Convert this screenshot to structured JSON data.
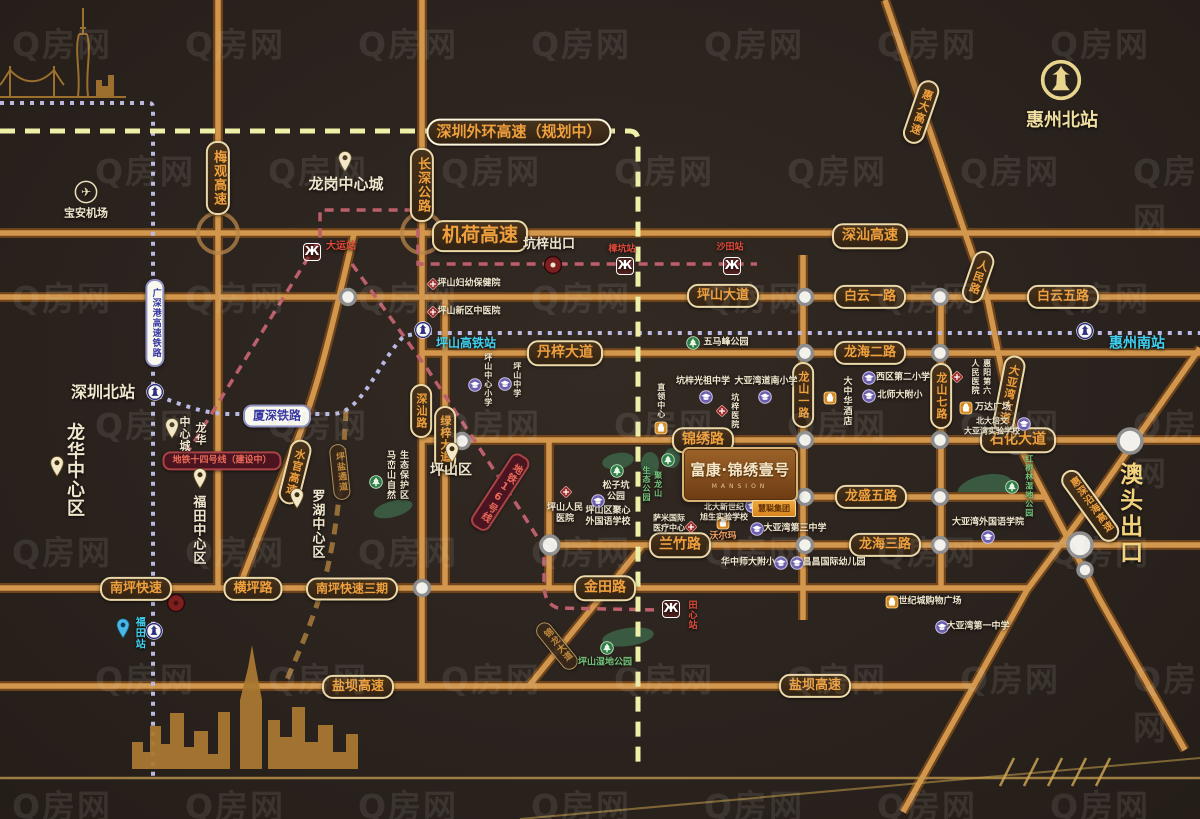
{
  "project": {
    "name": "富康·锦绣壹号",
    "name_en": "MANSION",
    "developer": "慧聪集团"
  },
  "watermark": {
    "text": "Q房网",
    "rows": 7,
    "cols": 7,
    "x_step": 173,
    "y_step": 127,
    "stagger": 95,
    "font_size": 33,
    "opacity": 0.11
  },
  "colors": {
    "background": "#2b231e",
    "road": "#d2974c",
    "road_casing": "#6f441b",
    "pill_text": "#f0a03c",
    "pill_border": "#ecd9a9",
    "rail_blue": "#3434a2",
    "metro_red": "#ee6a58",
    "cyan": "#3fd2f2",
    "cream": "#efe6cd",
    "green": "#74c47c",
    "gold": "#f2d27a"
  },
  "elements": [
    {
      "id": "label-jihe-expwy",
      "t": "机荷高速",
      "x": 480,
      "y": 236,
      "k": "pill",
      "fs": 19
    },
    {
      "id": "label-shenshan-expwy",
      "t": "深汕高速",
      "x": 870,
      "y": 236,
      "k": "pill",
      "fs": 14
    },
    {
      "id": "label-waihuan-expwy",
      "t": "深圳外环高速（规划中）",
      "x": 519,
      "y": 132,
      "k": "pill plan",
      "fs": 15
    },
    {
      "id": "label-pingshan-ave",
      "t": "坪山大道",
      "x": 723,
      "y": 296,
      "k": "pill",
      "fs": 13
    },
    {
      "id": "label-baiyun-1st-rd",
      "t": "白云一路",
      "x": 870,
      "y": 297,
      "k": "pill",
      "fs": 13
    },
    {
      "id": "label-baiyun-5th-rd",
      "t": "白云五路",
      "x": 1063,
      "y": 297,
      "k": "pill",
      "fs": 13
    },
    {
      "id": "label-danzi-ave",
      "t": "丹梓大道",
      "x": 565,
      "y": 353,
      "k": "pill",
      "fs": 14
    },
    {
      "id": "label-longhai-2nd-rd",
      "t": "龙海二路",
      "x": 870,
      "y": 353,
      "k": "pill",
      "fs": 13
    },
    {
      "id": "label-jinxiu-rd",
      "t": "锦绣路",
      "x": 703,
      "y": 440,
      "k": "pill",
      "fs": 14
    },
    {
      "id": "label-shihua-ave",
      "t": "石化大道",
      "x": 1018,
      "y": 440,
      "k": "pill",
      "fs": 14
    },
    {
      "id": "label-longsheng-5th-rd",
      "t": "龙盛五路",
      "x": 871,
      "y": 497,
      "k": "pill",
      "fs": 13
    },
    {
      "id": "label-lanzhu-rd",
      "t": "兰竹路",
      "x": 680,
      "y": 545,
      "k": "pill",
      "fs": 14
    },
    {
      "id": "label-longhai-3rd-rd",
      "t": "龙海三路",
      "x": 885,
      "y": 545,
      "k": "pill",
      "fs": 13
    },
    {
      "id": "label-nanping-expwy",
      "t": "南坪快速",
      "x": 136,
      "y": 589,
      "k": "pill",
      "fs": 13
    },
    {
      "id": "label-hengping-rd",
      "t": "横坪路",
      "x": 253,
      "y": 589,
      "k": "pill",
      "fs": 13
    },
    {
      "id": "label-nanping-phase3",
      "t": "南坪快速三期",
      "x": 352,
      "y": 589,
      "k": "pill",
      "fs": 12
    },
    {
      "id": "label-jintian-rd",
      "t": "金田路",
      "x": 605,
      "y": 588,
      "k": "pill",
      "fs": 14
    },
    {
      "id": "label-yanba-expwy-west",
      "t": "盐坝高速",
      "x": 358,
      "y": 687,
      "k": "pill",
      "fs": 13
    },
    {
      "id": "label-yanba-expwy-east",
      "t": "盐坝高速",
      "x": 815,
      "y": 686,
      "k": "pill",
      "fs": 13
    },
    {
      "id": "label-meiguan-expwy",
      "t": "梅观高速",
      "x": 218,
      "y": 178,
      "k": "pill v",
      "fs": 13
    },
    {
      "id": "label-changshen-hwy",
      "t": "长深公路",
      "x": 422,
      "y": 185,
      "k": "pill v",
      "fs": 13
    },
    {
      "id": "label-shenshan-rd",
      "t": "深汕路",
      "x": 421,
      "y": 411,
      "k": "pill v",
      "fs": 11
    },
    {
      "id": "label-lvzi-ave",
      "t": "绿梓大道",
      "x": 445,
      "y": 439,
      "k": "pill v",
      "fs": 11
    },
    {
      "id": "label-longshan-1st-rd",
      "t": "龙山一路",
      "x": 803,
      "y": 395,
      "k": "pill v",
      "fs": 11
    },
    {
      "id": "label-longshan-7th-rd",
      "t": "龙山七路",
      "x": 941,
      "y": 396,
      "k": "pill v",
      "fs": 11
    },
    {
      "id": "label-shuiguan-expwy",
      "t": "水官高速",
      "x": 295,
      "y": 472,
      "k": "pill v",
      "fs": 11,
      "rot": 14
    },
    {
      "id": "label-huida-expwy",
      "t": "惠大高速",
      "x": 921,
      "y": 112,
      "k": "pill v",
      "fs": 11,
      "rot": 19
    },
    {
      "id": "label-renmin-rd",
      "t": "人民路",
      "x": 978,
      "y": 277,
      "k": "pill v",
      "fs": 11,
      "rot": 19
    },
    {
      "id": "label-dayawan-ave",
      "t": "大亚湾大道",
      "x": 1009,
      "y": 394,
      "k": "pill v",
      "fs": 11,
      "rot": 11
    },
    {
      "id": "label-huishen-coastal-expwy",
      "t": "惠深沿海高速",
      "x": 1090,
      "y": 506,
      "k": "pill v",
      "fs": 10,
      "rot": -36
    },
    {
      "id": "label-jinlong-ave",
      "t": "锦龙大道",
      "x": 557,
      "y": 646,
      "k": "pill v dim",
      "fs": 9,
      "rot": -39
    },
    {
      "id": "label-pingyan-corridor",
      "t": "坪盐通道",
      "x": 340,
      "y": 472,
      "k": "pill v dim",
      "fs": 9,
      "rot": -6
    },
    {
      "id": "label-guangshengang-hsr",
      "t": "广深港高速铁路",
      "x": 155,
      "y": 323,
      "k": "pill prail v",
      "fs": 9
    },
    {
      "id": "label-xiashen-railway",
      "t": "厦深铁路",
      "x": 277,
      "y": 416,
      "k": "pill prail",
      "fs": 12
    },
    {
      "id": "label-metro-line14",
      "t": "地铁十四号线（建设中）",
      "x": 222,
      "y": 461,
      "k": "pill pmetro",
      "fs": 9
    },
    {
      "id": "label-metro-line16",
      "t": "地铁16号线",
      "x": 500,
      "y": 492,
      "k": "pill pmetro v",
      "fs": 10,
      "rot": 33
    },
    {
      "id": "huizhou-north-station-icon",
      "ic": "railgold",
      "x": 1061,
      "y": 80,
      "k": "ico-wrap"
    },
    {
      "id": "huizhou-north-station",
      "t": "惠州北站",
      "x": 1062,
      "y": 121,
      "fs": 18,
      "c": "#f0dfa0"
    },
    {
      "id": "shenzhen-north-station-icon",
      "ic": "rail",
      "x": 155,
      "y": 392,
      "k": "ico-wrap"
    },
    {
      "id": "shenzhen-north-station",
      "t": "深圳北站",
      "x": 103,
      "y": 392,
      "fs": 16
    },
    {
      "id": "pingshan-hsr-station-icon",
      "ic": "rail",
      "x": 423,
      "y": 330,
      "k": "ico-wrap"
    },
    {
      "id": "pingshan-hsr-station",
      "t": "坪山高铁站",
      "x": 466,
      "y": 343,
      "k": "cyan",
      "fs": 12
    },
    {
      "id": "huizhou-south-station-icon",
      "ic": "rail",
      "x": 1085,
      "y": 331,
      "k": "ico-wrap"
    },
    {
      "id": "huizhou-south-station",
      "t": "惠州南站",
      "x": 1137,
      "y": 344,
      "k": "cyan",
      "fs": 14
    },
    {
      "id": "futian-station-icon",
      "ic": "rail",
      "x": 154,
      "y": 631,
      "k": "ico-wrap"
    },
    {
      "id": "futian-station-pin",
      "ic": "pinblue",
      "x": 123,
      "y": 628,
      "k": "ico-wrap"
    },
    {
      "id": "futian-station",
      "t": "福田站",
      "x": 138,
      "y": 633,
      "k": "v cyan",
      "fs": 10
    },
    {
      "id": "dayun-station-icon",
      "ic": "metro",
      "x": 312,
      "y": 252,
      "k": "ico-wrap"
    },
    {
      "id": "dayun-station",
      "t": "大运站",
      "x": 341,
      "y": 247,
      "k": "red",
      "fs": 10
    },
    {
      "id": "zhangkeng-station",
      "t": "樟坑站",
      "x": 622,
      "y": 250,
      "k": "red",
      "fs": 9
    },
    {
      "id": "zhangkeng-station-icon",
      "ic": "metro",
      "x": 625,
      "y": 266,
      "k": "ico-wrap"
    },
    {
      "id": "shatian-station",
      "t": "沙田站",
      "x": 730,
      "y": 248,
      "k": "red",
      "fs": 9
    },
    {
      "id": "shatian-station-icon",
      "ic": "metro",
      "x": 732,
      "y": 266,
      "k": "ico-wrap"
    },
    {
      "id": "tianxin-station-icon",
      "ic": "metro",
      "x": 671,
      "y": 609,
      "k": "ico-wrap"
    },
    {
      "id": "tianxin-station",
      "t": "田心站",
      "x": 691,
      "y": 615,
      "k": "v red",
      "fs": 9
    },
    {
      "id": "kengzi-exit",
      "t": "坑梓出口",
      "x": 549,
      "y": 245,
      "fs": 13
    },
    {
      "id": "aotou-exit",
      "t": "澳头出口",
      "x": 1128,
      "y": 514,
      "k": "v gold big",
      "fs": 23
    },
    {
      "id": "longgang-central-city-pin",
      "ic": "pin",
      "x": 345,
      "y": 161,
      "k": "ico-wrap"
    },
    {
      "id": "longgang-central-city",
      "t": "龙岗中心城",
      "x": 346,
      "y": 184,
      "fs": 15
    },
    {
      "id": "baoan-airport-icon",
      "ic": "plane",
      "x": 86,
      "y": 192,
      "k": "ico-wrap"
    },
    {
      "id": "baoan-airport",
      "t": "宝安机场",
      "x": 86,
      "y": 213,
      "fs": 11
    },
    {
      "id": "longhua-central-city-pin",
      "ic": "pin",
      "x": 172,
      "y": 428,
      "k": "ico-wrap"
    },
    {
      "id": "longhua-central-city",
      "t": "龙华\n中心城",
      "x": 192,
      "y": 434,
      "k": "v",
      "fs": 11
    },
    {
      "id": "longhua-central-district-pin",
      "ic": "pin",
      "x": 57,
      "y": 466,
      "k": "ico-wrap"
    },
    {
      "id": "longhua-central-district",
      "t": "龙华中心区",
      "x": 74,
      "y": 470,
      "k": "v",
      "fs": 18
    },
    {
      "id": "futian-central-district-pin",
      "ic": "pin",
      "x": 200,
      "y": 478,
      "k": "ico-wrap"
    },
    {
      "id": "futian-central-district",
      "t": "福田中心区",
      "x": 197,
      "y": 530,
      "k": "v",
      "fs": 13
    },
    {
      "id": "luohu-central-district-pin",
      "ic": "pin",
      "x": 297,
      "y": 498,
      "k": "ico-wrap"
    },
    {
      "id": "luohu-central-district",
      "t": "罗湖中心区",
      "x": 316,
      "y": 524,
      "k": "v",
      "fs": 13
    },
    {
      "id": "pingshan-district-pin",
      "ic": "pin",
      "x": 452,
      "y": 452,
      "k": "ico-wrap"
    },
    {
      "id": "pingshan-district",
      "t": "坪山区",
      "x": 451,
      "y": 471,
      "fs": 14
    },
    {
      "id": "maluanshan-reserve",
      "t": "马峦山自然\n生态保护区",
      "x": 396,
      "y": 475,
      "k": "vlr",
      "fs": 9
    },
    {
      "id": "maluanshan-park-icon",
      "ic": "park",
      "x": 376,
      "y": 482,
      "k": "ico-wrap"
    },
    {
      "id": "psfy-hospital-icon",
      "ic": "hosp",
      "x": 433,
      "y": 284,
      "k": "ico-wrap"
    },
    {
      "id": "psfy-hospital",
      "t": "坪山妇幼保健院",
      "x": 469,
      "y": 284,
      "fs": 9
    },
    {
      "id": "pszx-tcm-hospital-icon",
      "ic": "hosp",
      "x": 433,
      "y": 312,
      "k": "ico-wrap"
    },
    {
      "id": "pszx-tcm-hospital",
      "t": "坪山新区中医院",
      "x": 469,
      "y": 312,
      "fs": 9
    },
    {
      "id": "pingshan-central-primary-icon",
      "ic": "school",
      "x": 475,
      "y": 385,
      "k": "ico-wrap"
    },
    {
      "id": "pingshan-central-primary",
      "t": "坪山中心小学",
      "x": 488,
      "y": 380,
      "k": "v",
      "fs": 8
    },
    {
      "id": "pingshan-middle-school-icon",
      "ic": "school",
      "x": 505,
      "y": 384,
      "k": "ico-wrap"
    },
    {
      "id": "pingshan-middle-school",
      "t": "坪山中学",
      "x": 517,
      "y": 380,
      "k": "v",
      "fs": 8
    },
    {
      "id": "wumafeng-park-icon",
      "ic": "park",
      "x": 693,
      "y": 343,
      "k": "ico-wrap"
    },
    {
      "id": "wumafeng-park",
      "t": "五马峰公园",
      "x": 726,
      "y": 343,
      "fs": 9
    },
    {
      "id": "kengzi-guangzu-middle",
      "t": "坑梓光祖中学",
      "x": 703,
      "y": 382,
      "fs": 9
    },
    {
      "id": "kengzi-guangzu-middle-icon",
      "ic": "school",
      "x": 706,
      "y": 397,
      "k": "ico-wrap"
    },
    {
      "id": "dayawan-daonan-primary",
      "t": "大亚湾道南小学",
      "x": 766,
      "y": 382,
      "fs": 9
    },
    {
      "id": "dayawan-daonan-primary-icon",
      "ic": "school",
      "x": 765,
      "y": 397,
      "k": "ico-wrap"
    },
    {
      "id": "kengzi-hospital-icon",
      "ic": "hosp",
      "x": 722,
      "y": 411,
      "k": "ico-wrap"
    },
    {
      "id": "kengzi-hospital",
      "t": "坑梓医院",
      "x": 735,
      "y": 411,
      "k": "v",
      "fs": 8
    },
    {
      "id": "zhiling-center",
      "t": "直领中心",
      "x": 661,
      "y": 401,
      "k": "v",
      "fs": 8
    },
    {
      "id": "zhiling-center-icon",
      "ic": "shop",
      "x": 661,
      "y": 428,
      "k": "ico-wrap"
    },
    {
      "id": "dazhonghua-hotel-icon",
      "ic": "shop",
      "x": 830,
      "y": 398,
      "k": "ico-wrap"
    },
    {
      "id": "dazhonghua-hotel",
      "t": "大中华酒店",
      "x": 846,
      "y": 401,
      "k": "v",
      "fs": 9
    },
    {
      "id": "xiqu-2nd-primary-icon",
      "ic": "school",
      "x": 869,
      "y": 378,
      "k": "ico-wrap"
    },
    {
      "id": "xiqu-2nd-primary",
      "t": "西区第二小学",
      "x": 903,
      "y": 378,
      "fs": 9
    },
    {
      "id": "beishida-primary-icon",
      "ic": "school",
      "x": 869,
      "y": 396,
      "k": "ico-wrap"
    },
    {
      "id": "beishida-primary",
      "t": "北师大附小",
      "x": 900,
      "y": 396,
      "fs": 9
    },
    {
      "id": "huiyang-6th-hospital-icon",
      "ic": "hosp",
      "x": 957,
      "y": 377,
      "k": "ico-wrap"
    },
    {
      "id": "huiyang-6th-hospital",
      "t": "惠阳第六\n人民医院",
      "x": 981,
      "y": 377,
      "k": "v",
      "fs": 8
    },
    {
      "id": "wanda-plaza-icon",
      "ic": "shop",
      "x": 966,
      "y": 408,
      "k": "ico-wrap"
    },
    {
      "id": "wanda-plaza",
      "t": "万达广场",
      "x": 993,
      "y": 408,
      "fs": 9
    },
    {
      "id": "beida-peiwen-school",
      "t": "北大培文\n大亚湾实验学校",
      "x": 992,
      "y": 426,
      "fs": 8
    },
    {
      "id": "beida-peiwen-school-icon",
      "ic": "school",
      "x": 1024,
      "y": 424,
      "k": "ico-wrap"
    },
    {
      "id": "songzikeng-park-icon",
      "ic": "park",
      "x": 617,
      "y": 471,
      "k": "ico-wrap"
    },
    {
      "id": "songzikeng-park",
      "t": "松子坑\n公园",
      "x": 616,
      "y": 492,
      "fs": 9
    },
    {
      "id": "pingshan-people-hospital-icon",
      "ic": "hosp",
      "x": 566,
      "y": 492,
      "k": "ico-wrap"
    },
    {
      "id": "pingshan-people-hospital",
      "t": "坪山人民\n医院",
      "x": 565,
      "y": 514,
      "fs": 9
    },
    {
      "id": "pingshan-juxin-school-icon",
      "ic": "school",
      "x": 598,
      "y": 501,
      "k": "ico-wrap"
    },
    {
      "id": "pingshan-juxin-school",
      "t": "坪山区聚心\n外国语学校",
      "x": 608,
      "y": 517,
      "fs": 9
    },
    {
      "id": "julongshan-park-icon",
      "ic": "park",
      "x": 668,
      "y": 460,
      "k": "ico-wrap"
    },
    {
      "id": "julongshan-park",
      "t": "聚龙山\n生态公园",
      "x": 652,
      "y": 484,
      "k": "v green",
      "fs": 8
    },
    {
      "id": "sami-medical",
      "t": "萨米国际\n医疗中心",
      "x": 669,
      "y": 523,
      "fs": 8
    },
    {
      "id": "sami-medical-icon",
      "ic": "hosp",
      "x": 691,
      "y": 527,
      "k": "ico-wrap"
    },
    {
      "id": "walmart-icon",
      "ic": "shop",
      "x": 723,
      "y": 523,
      "k": "ico-wrap"
    },
    {
      "id": "walmart",
      "t": "沃尔玛",
      "x": 723,
      "y": 537,
      "fs": 9,
      "c": "#f0a060"
    },
    {
      "id": "beida-xinshiji-school",
      "t": "北大新世纪\n旭生实验学校",
      "x": 724,
      "y": 512,
      "fs": 8
    },
    {
      "id": "beida-xinshiji-school-icon",
      "ic": "school",
      "x": 752,
      "y": 506,
      "k": "ico-wrap"
    },
    {
      "id": "dayawan-3rd-middle-icon",
      "ic": "school",
      "x": 757,
      "y": 529,
      "k": "ico-wrap"
    },
    {
      "id": "dayawan-3rd-middle",
      "t": "大亚湾第三中学",
      "x": 795,
      "y": 529,
      "fs": 9
    },
    {
      "id": "huazhong-shida-primary",
      "t": "华中师大附小",
      "x": 748,
      "y": 563,
      "fs": 9
    },
    {
      "id": "huazhong-shida-primary-icon",
      "ic": "school",
      "x": 781,
      "y": 563,
      "k": "ico-wrap"
    },
    {
      "id": "changchang-kindergarten-icon",
      "ic": "school",
      "x": 797,
      "y": 563,
      "k": "ico-wrap"
    },
    {
      "id": "changchang-kindergarten",
      "t": "昌昌国际幼儿园",
      "x": 834,
      "y": 563,
      "fs": 9
    },
    {
      "id": "century-city-mall-icon",
      "ic": "shop",
      "x": 892,
      "y": 602,
      "k": "ico-wrap"
    },
    {
      "id": "century-city-mall",
      "t": "世纪城购物广场",
      "x": 930,
      "y": 602,
      "fs": 9
    },
    {
      "id": "dayawan-1st-middle-icon",
      "ic": "school",
      "x": 942,
      "y": 627,
      "k": "ico-wrap"
    },
    {
      "id": "dayawan-1st-middle",
      "t": "大亚湾第一中学",
      "x": 978,
      "y": 627,
      "fs": 9
    },
    {
      "id": "dayawan-foreign-college",
      "t": "大亚湾外国语学院",
      "x": 988,
      "y": 523,
      "fs": 9
    },
    {
      "id": "dayawan-foreign-college-icon",
      "ic": "school",
      "x": 988,
      "y": 537,
      "k": "ico-wrap"
    },
    {
      "id": "hongshulin-park-icon",
      "ic": "park",
      "x": 1012,
      "y": 487,
      "k": "ico-wrap"
    },
    {
      "id": "hongshulin-park",
      "t": "红树林湿地公园",
      "x": 1029,
      "y": 486,
      "k": "v green",
      "fs": 8
    },
    {
      "id": "pingshan-wetland-park-icon",
      "ic": "park",
      "x": 607,
      "y": 648,
      "k": "ico-wrap"
    },
    {
      "id": "pingshan-wetland-park",
      "t": "坪山湿地公园",
      "x": 605,
      "y": 663,
      "k": "green",
      "fs": 9
    }
  ]
}
